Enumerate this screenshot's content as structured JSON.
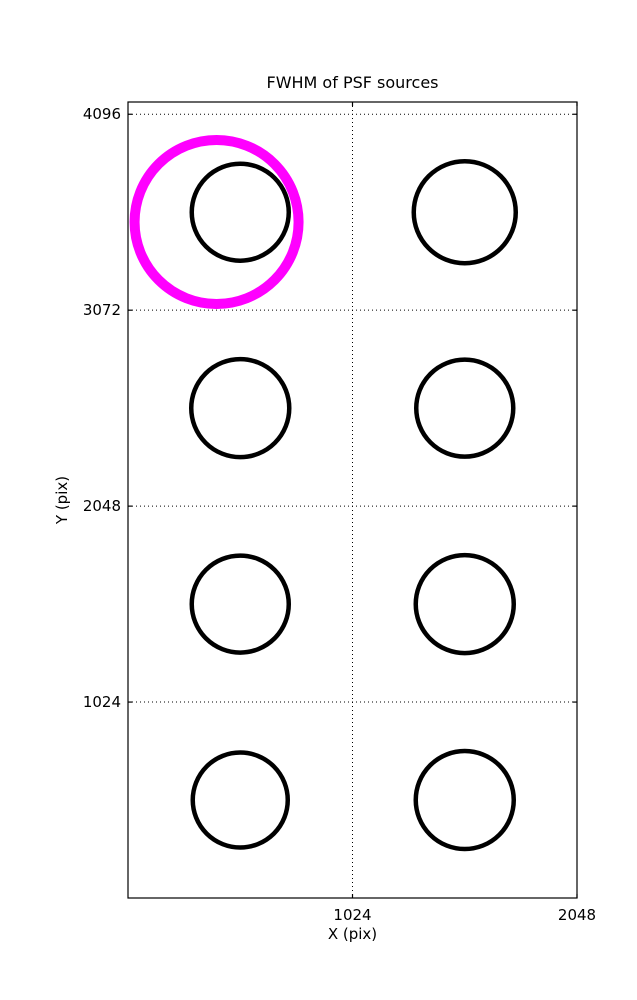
{
  "figure": {
    "background": "#ffffff"
  },
  "chart_data": {
    "type": "scatter",
    "title": "FWHM of PSF sources",
    "xlabel": "X (pix)",
    "ylabel": "Y (pix)",
    "xlim": [
      0,
      2048
    ],
    "ylim": [
      0,
      4160
    ],
    "xticks": [
      1024,
      2048
    ],
    "yticks": [
      1024,
      2048,
      3072,
      4096
    ],
    "xtick_labels": [
      "1024",
      "2048"
    ],
    "ytick_labels": [
      "1024",
      "2048",
      "3072",
      "4096"
    ],
    "grid": {
      "style": "dotted",
      "x_at": [
        1024
      ],
      "y_at": [
        1024,
        2048,
        3072,
        4096
      ]
    },
    "legend": "none",
    "axis_color": "#000000",
    "grid_color": "#000000",
    "marker": {
      "shape": "circle-outline",
      "color": "#000000",
      "linewidth_px": 4.5
    },
    "sources": [
      {
        "x": 512,
        "y": 3584,
        "radius_px": 48.5
      },
      {
        "x": 1536,
        "y": 3584,
        "radius_px": 51
      },
      {
        "x": 512,
        "y": 2560,
        "radius_px": 49
      },
      {
        "x": 1536,
        "y": 2560,
        "radius_px": 48.5
      },
      {
        "x": 512,
        "y": 1536,
        "radius_px": 48.5
      },
      {
        "x": 1536,
        "y": 1536,
        "radius_px": 49
      },
      {
        "x": 512,
        "y": 512,
        "radius_px": 47.5
      },
      {
        "x": 1536,
        "y": 512,
        "radius_px": 49
      }
    ],
    "highlight": {
      "x": 404,
      "y": 3533,
      "radius_px": 82,
      "color": "#ff00ff",
      "linewidth_px": 10
    }
  }
}
